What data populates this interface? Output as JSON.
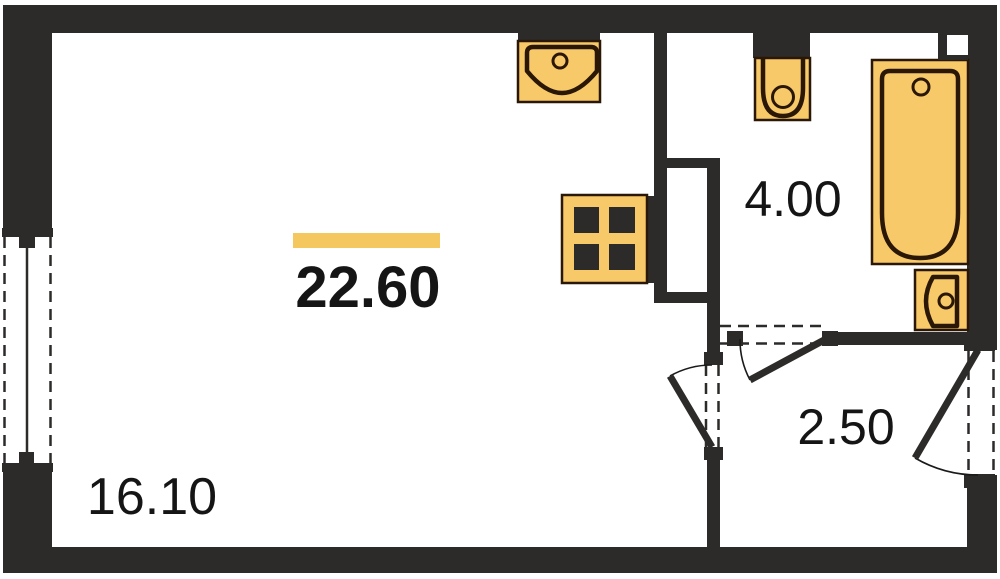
{
  "plan": {
    "total_area": "22.60",
    "rooms": [
      {
        "name": "living-room",
        "area": "16.10"
      },
      {
        "name": "bathroom",
        "area": "4.00"
      },
      {
        "name": "hallway",
        "area": "2.50"
      }
    ],
    "fixtures": [
      "kitchen-sink",
      "stove",
      "toilet",
      "bathtub",
      "washbasin"
    ],
    "colors": {
      "wall": "#2d2b29",
      "fixture_fill": "#f8c968",
      "fixture_outline": "#2b1706",
      "accent_bar": "#f5c75f",
      "text": "#151515"
    }
  }
}
